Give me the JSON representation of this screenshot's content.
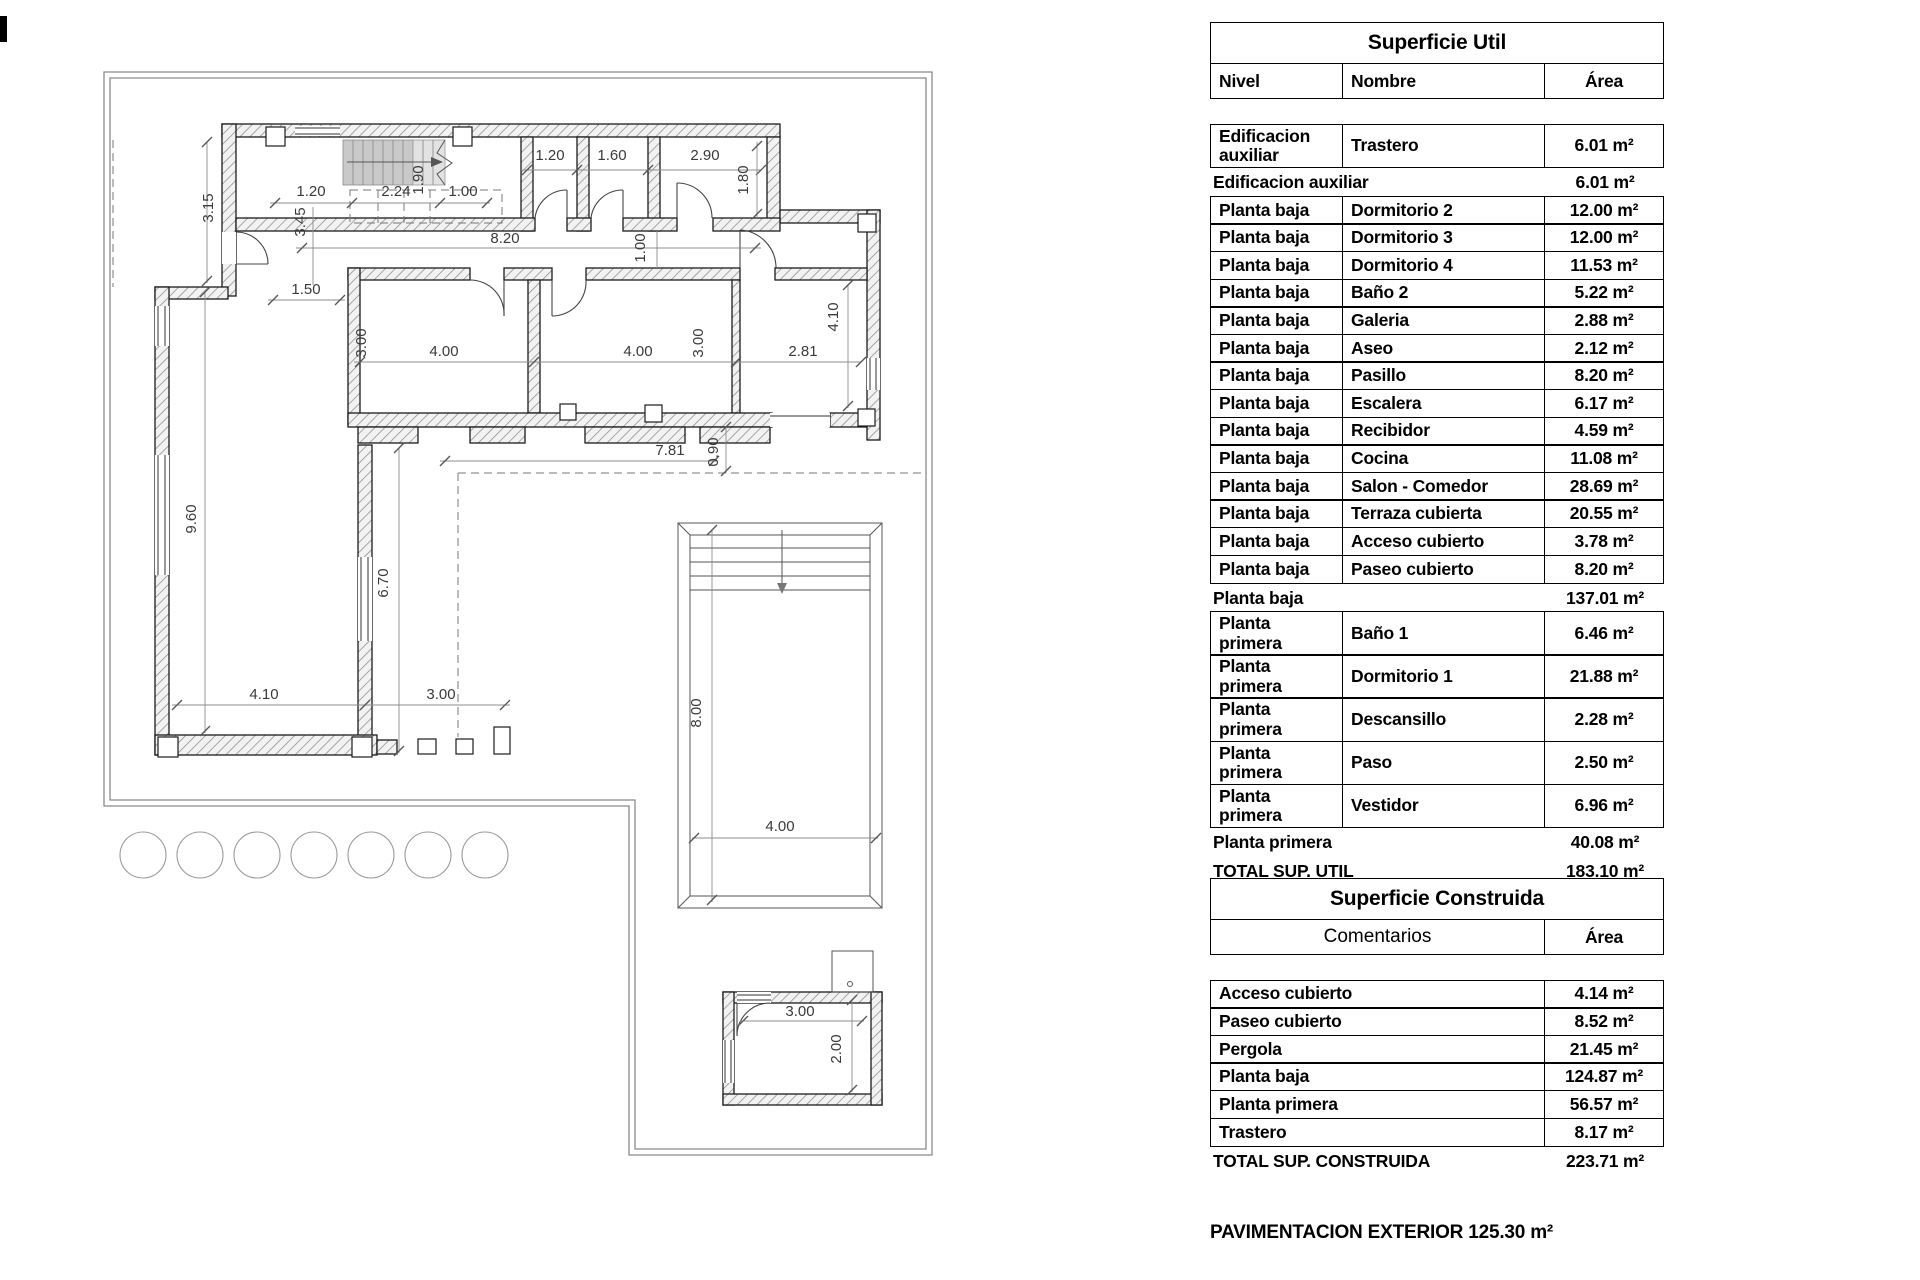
{
  "superficie_util": {
    "title": "Superficie Util",
    "headers": {
      "nivel": "Nivel",
      "nombre": "Nombre",
      "area": "Área"
    },
    "rows": [
      {
        "type": "data",
        "nivel": "Edificacion auxiliar",
        "nombre": "Trastero",
        "area": "6.01 m²"
      },
      {
        "type": "subtotal",
        "label": "Edificacion auxiliar",
        "area": "6.01 m²"
      },
      {
        "type": "data",
        "nivel": "Planta baja",
        "nombre": "Dormitorio 2",
        "area": "12.00 m²"
      },
      {
        "type": "data",
        "nivel": "Planta baja",
        "nombre": "Dormitorio 3",
        "area": "12.00 m²"
      },
      {
        "type": "data",
        "nivel": "Planta baja",
        "nombre": "Dormitorio 4",
        "area": "11.53 m²"
      },
      {
        "type": "data",
        "nivel": "Planta baja",
        "nombre": "Baño 2",
        "area": "5.22 m²"
      },
      {
        "type": "data",
        "nivel": "Planta baja",
        "nombre": "Galeria",
        "area": "2.88 m²"
      },
      {
        "type": "data",
        "nivel": "Planta baja",
        "nombre": "Aseo",
        "area": "2.12 m²"
      },
      {
        "type": "data",
        "nivel": "Planta baja",
        "nombre": "Pasillo",
        "area": "8.20 m²"
      },
      {
        "type": "data",
        "nivel": "Planta baja",
        "nombre": "Escalera",
        "area": "6.17 m²"
      },
      {
        "type": "data",
        "nivel": "Planta baja",
        "nombre": "Recibidor",
        "area": "4.59 m²"
      },
      {
        "type": "data",
        "nivel": "Planta baja",
        "nombre": "Cocina",
        "area": "11.08 m²"
      },
      {
        "type": "data",
        "nivel": "Planta baja",
        "nombre": "Salon - Comedor",
        "area": "28.69 m²"
      },
      {
        "type": "data",
        "nivel": "Planta baja",
        "nombre": "Terraza cubierta",
        "area": "20.55 m²"
      },
      {
        "type": "data",
        "nivel": "Planta baja",
        "nombre": "Acceso cubierto",
        "area": "3.78 m²"
      },
      {
        "type": "data",
        "nivel": "Planta baja",
        "nombre": "Paseo cubierto",
        "area": "8.20 m²"
      },
      {
        "type": "subtotal",
        "label": "Planta baja",
        "area": "137.01 m²"
      },
      {
        "type": "data",
        "nivel": "Planta primera",
        "nombre": "Baño 1",
        "area": "6.46 m²"
      },
      {
        "type": "data",
        "nivel": "Planta primera",
        "nombre": "Dormitorio 1",
        "area": "21.88 m²"
      },
      {
        "type": "data",
        "nivel": "Planta primera",
        "nombre": "Descansillo",
        "area": "2.28 m²"
      },
      {
        "type": "data",
        "nivel": "Planta primera",
        "nombre": "Paso",
        "area": "2.50 m²"
      },
      {
        "type": "data",
        "nivel": "Planta primera",
        "nombre": "Vestidor",
        "area": "6.96 m²"
      },
      {
        "type": "subtotal",
        "label": "Planta primera",
        "area": "40.08 m²"
      }
    ],
    "total": {
      "label": "TOTAL SUP. UTIL",
      "area": "183.10 m²"
    }
  },
  "superficie_construida": {
    "title": "Superficie Construida",
    "headers": {
      "comentarios": "Comentarios",
      "area": "Área"
    },
    "rows": [
      {
        "label": "Acceso cubierto",
        "area": "4.14 m²"
      },
      {
        "label": "Paseo cubierto",
        "area": "8.52 m²"
      },
      {
        "label": "Pergola",
        "area": "21.45 m²"
      },
      {
        "label": "Planta baja",
        "area": "124.87 m²"
      },
      {
        "label": "Planta primera",
        "area": "56.57 m²"
      },
      {
        "label": "Trastero",
        "area": "8.17 m²"
      }
    ],
    "total": {
      "label": "TOTAL SUP. CONSTRUIDA",
      "area": "223.71 m²"
    }
  },
  "footer": {
    "text": "PAVIMENTACION EXTERIOR 125.30 m²"
  },
  "plan": {
    "dims": [
      "3.15",
      "3.45",
      "1.20",
      "2.24",
      "1.00",
      "1.90",
      "1.20",
      "1.60",
      "2.90",
      "1.80",
      "8.20",
      "1.00",
      "1.50",
      "3.00",
      "4.00",
      "4.00",
      "3.00",
      "2.81",
      "4.10",
      "7.81",
      "0.90",
      "9.60",
      "6.70",
      "4.10",
      "3.00",
      "8.00",
      "4.00",
      "3.00",
      "2.00"
    ]
  }
}
